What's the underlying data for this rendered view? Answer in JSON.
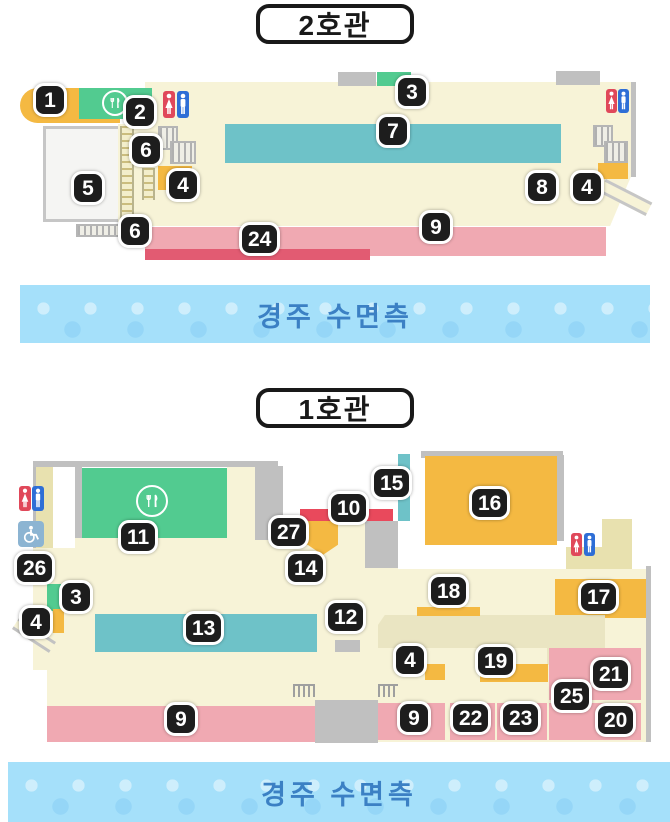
{
  "building2": {
    "title": "2호관",
    "badges": [
      "1",
      "2",
      "3",
      "7",
      "6",
      "4",
      "5",
      "8",
      "4",
      "6",
      "24",
      "9"
    ]
  },
  "building1": {
    "title": "1호관",
    "badges": [
      "15",
      "10",
      "16",
      "11",
      "27",
      "14",
      "26",
      "3",
      "18",
      "17",
      "12",
      "13",
      "4",
      "4",
      "19",
      "21",
      "25",
      "20",
      "9",
      "9",
      "22",
      "23"
    ]
  },
  "banners": [
    {
      "text": "경주 수면측"
    },
    {
      "text": "경주 수면측"
    }
  ],
  "icons": {
    "restaurant": "fork-knife-icon",
    "female_restroom": "female-figure-icon",
    "male_restroom": "male-figure-icon",
    "wheelchair": "wheelchair-accessible-icon"
  },
  "colors": {
    "floor_cream": "#f7f3d7",
    "corridor_beige": "#eae5c2",
    "wall_tan": "#e8e1af",
    "zone_orange": "#f4b942",
    "zone_green": "#52cb90",
    "zone_teal": "#6ec2c8",
    "zone_pink": "#f0a9b2",
    "zone_red": "#e9495c",
    "zone_crimson": "#e25b72",
    "wall_gray": "#c0c0c0",
    "badge_bg": "#1d1d1d",
    "banner_bg": "#a5e0fa",
    "banner_text": "#3b80c4",
    "wheelchair_bg": "#8cb4d2",
    "restroom_red": "#e0485a",
    "restroom_blue": "#2e6ed6"
  }
}
